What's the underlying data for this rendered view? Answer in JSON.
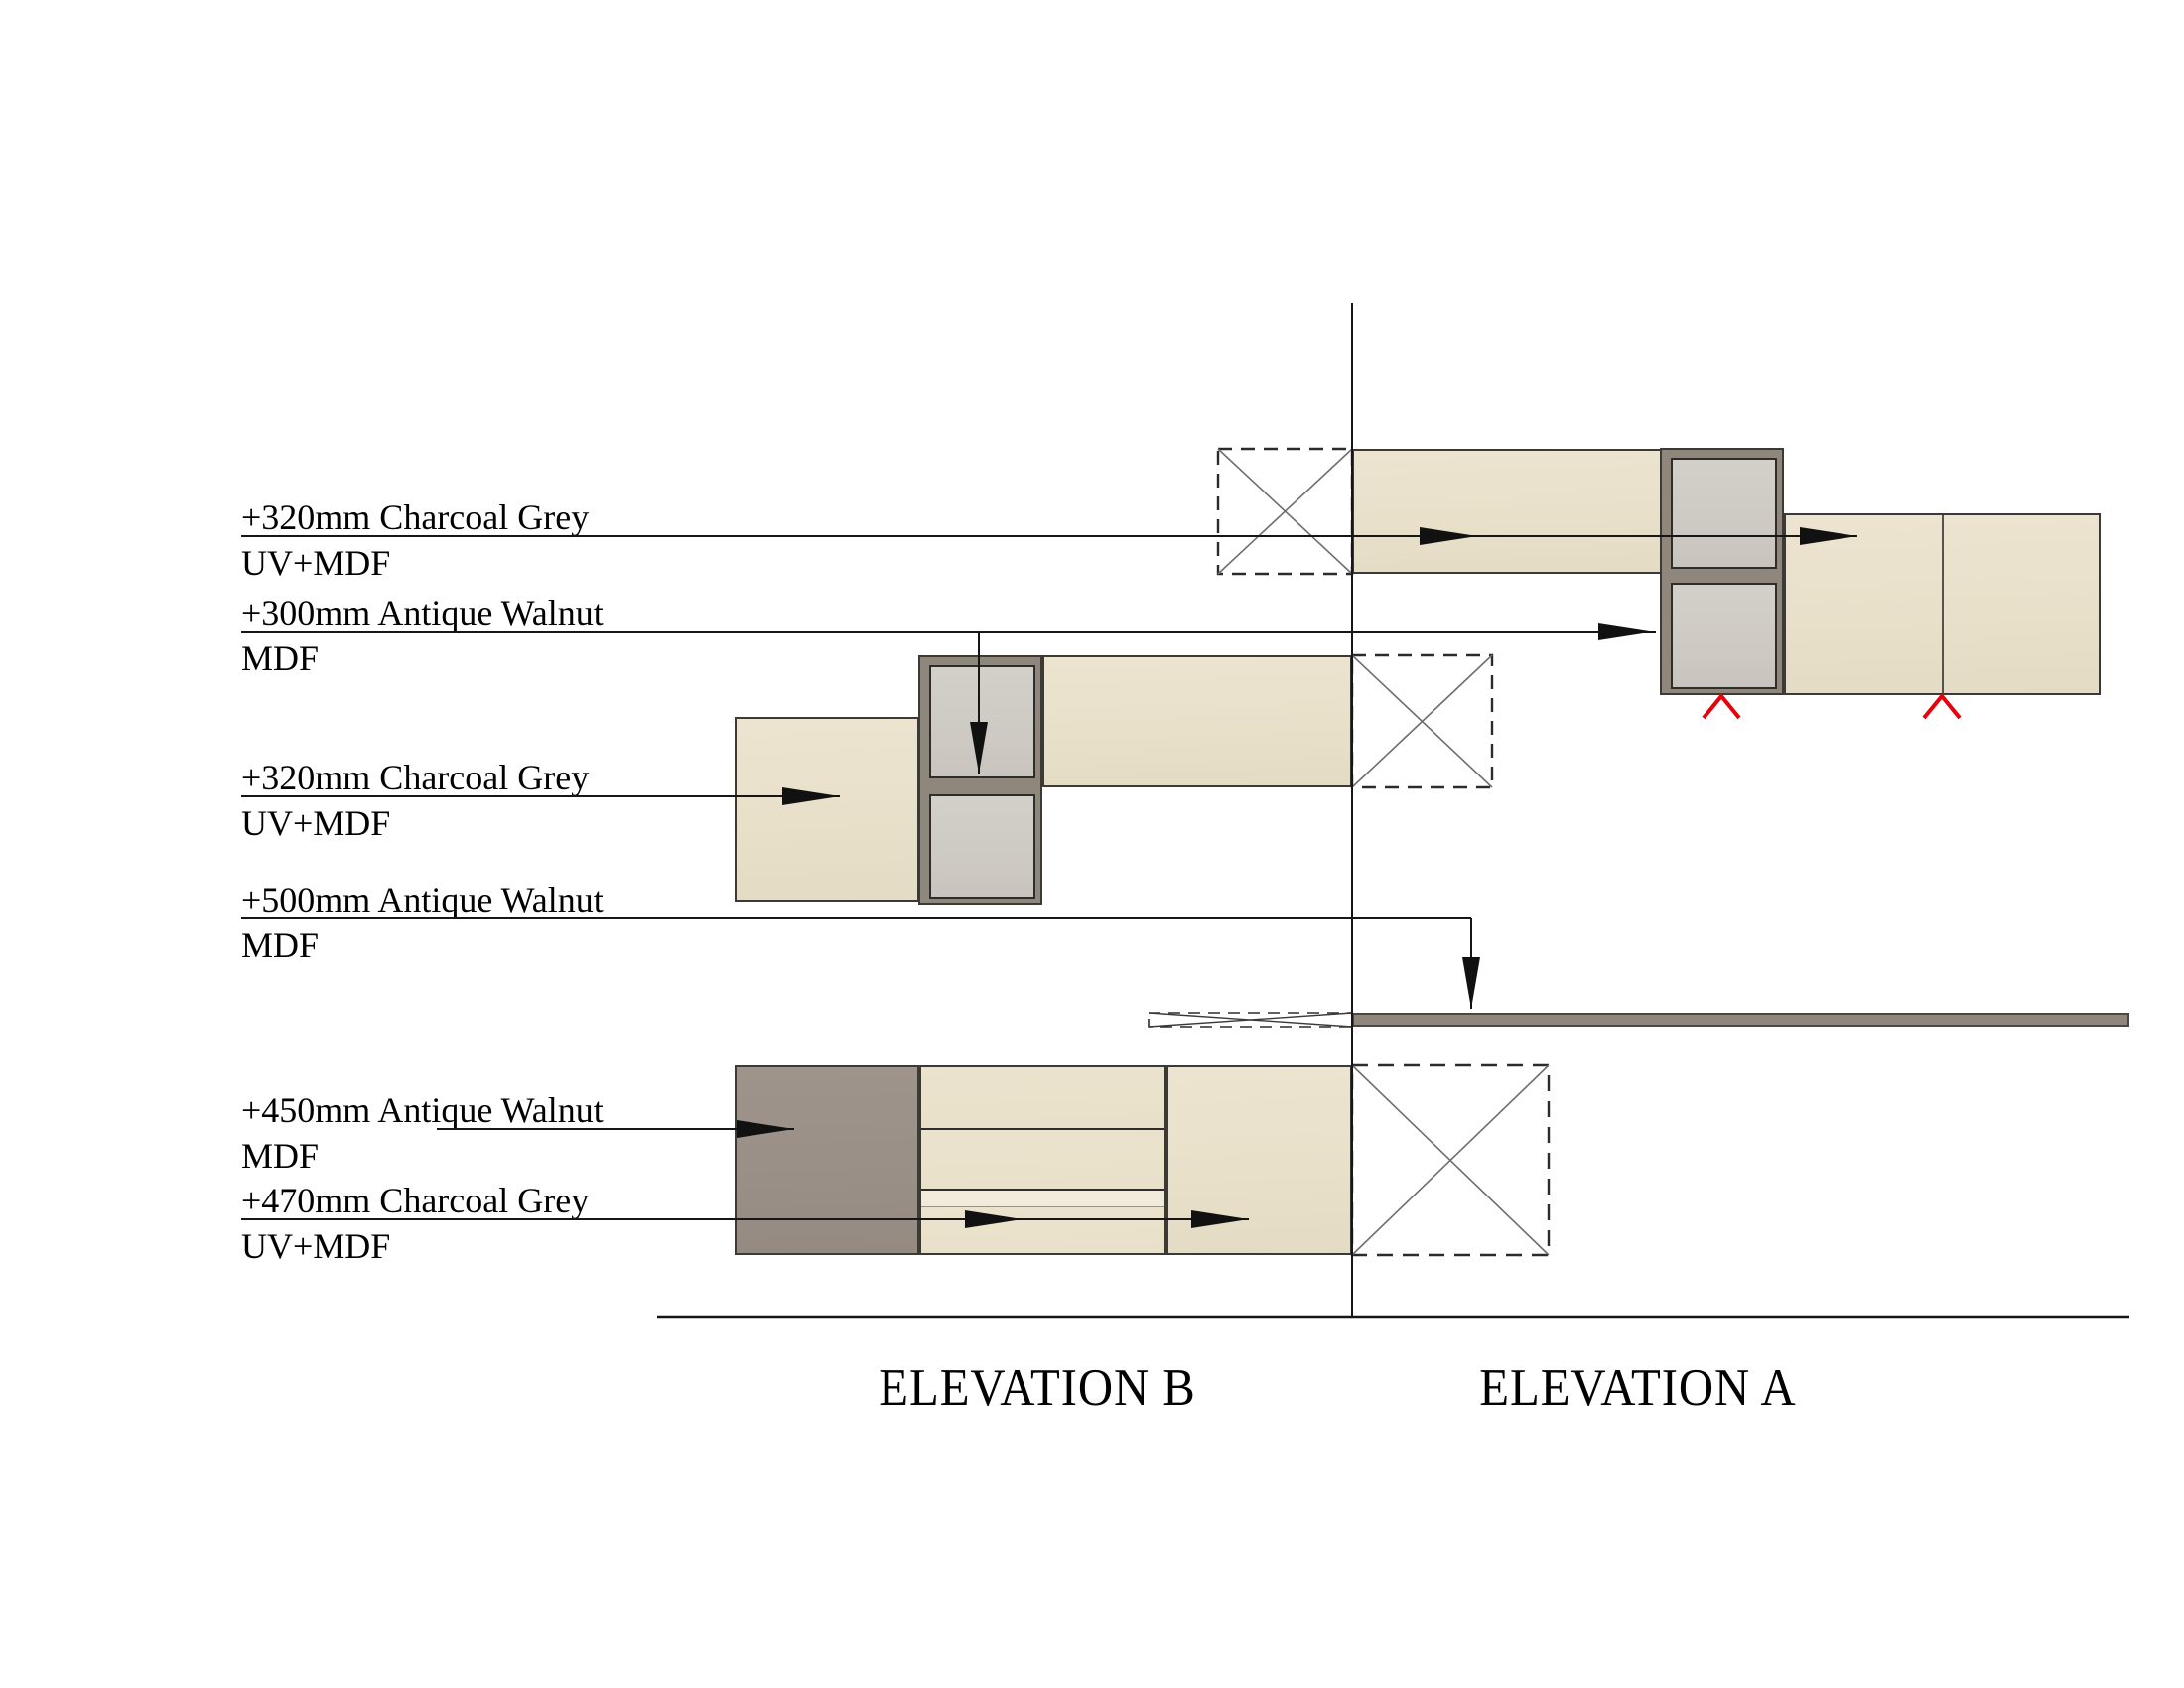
{
  "document": {
    "type": "interior-joinery-elevation-drawing",
    "background": "#ffffff"
  },
  "titles": {
    "elevation_b": "ELEVATION B",
    "elevation_a": "ELEVATION A"
  },
  "labels": [
    {
      "line1": "+320mm Charcoal Grey",
      "line2": "UV+MDF"
    },
    {
      "line1": "+300mm Antique Walnut",
      "line2": "MDF"
    },
    {
      "line1": "+320mm Charcoal Grey",
      "line2": "UV+MDF"
    },
    {
      "line1": "+500mm Antique Walnut",
      "line2": "MDF"
    },
    {
      "line1": "+450mm Antique Walnut",
      "line2": "MDF"
    },
    {
      "line1": "+470mm Charcoal Grey",
      "line2": "UV+MDF"
    }
  ],
  "icons": [
    {
      "name": "red-hinge-marker",
      "glyph": "∧",
      "color": "#e8000a",
      "count": 2
    },
    {
      "name": "void-x-box",
      "glyph": "☒",
      "count": 3
    },
    {
      "name": "shelf-void-bowtie",
      "glyph": "⋈",
      "count": 1
    }
  ],
  "colors": {
    "background": "#ffffff",
    "panel_beige": "#e8e0c9",
    "walnut_grey": "#998f86",
    "cabinet_frame": "#8f867c",
    "cabinet_door_grey": "#cdc9c2",
    "shelf_taupe": "#90867c",
    "outline_dark": "#3b3a34",
    "leader_line": "#161616",
    "void_cross": "#6e6e6e",
    "red_marker": "#e8000a",
    "text": "#000000"
  }
}
